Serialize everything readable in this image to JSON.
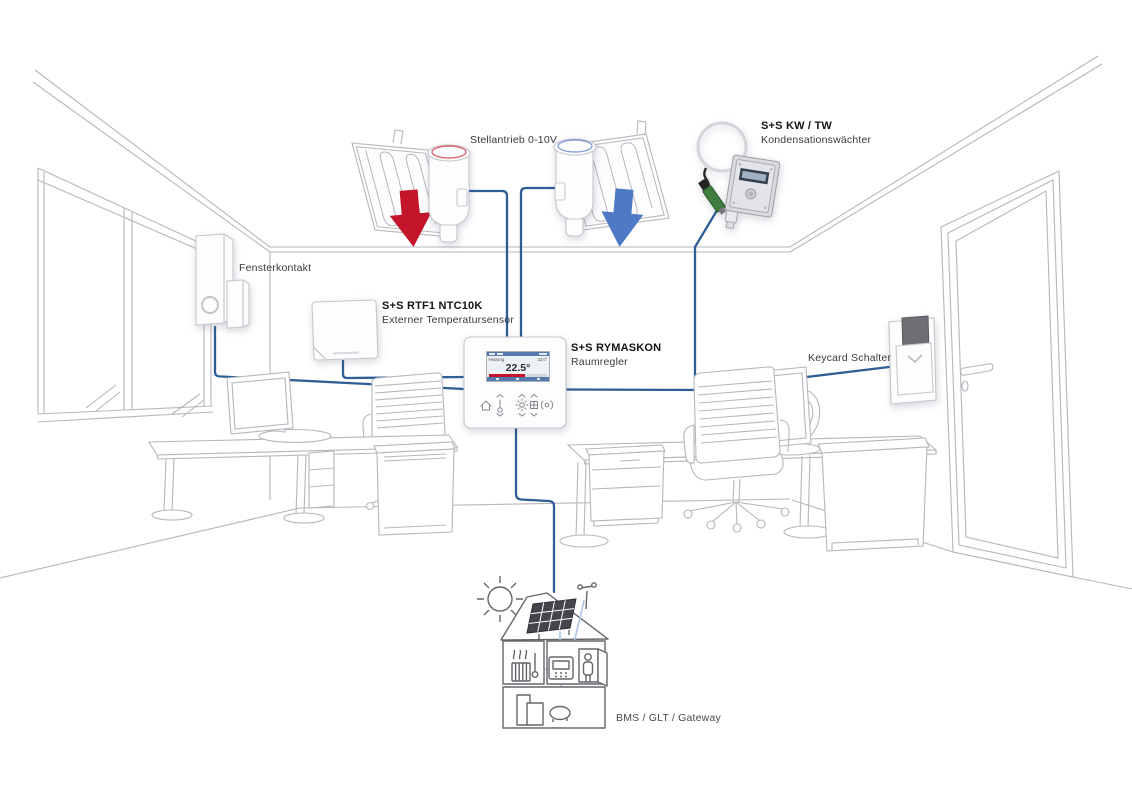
{
  "diagram": {
    "labels": {
      "actuator": {
        "text": "Stellantrieb 0-10V"
      },
      "condensation": {
        "title": "S+S KW / TW",
        "subtitle": "Kondensationswächter"
      },
      "window_contact": {
        "text": "Fensterkontakt"
      },
      "ext_temp_sensor": {
        "title": "S+S RTF1 NTC10K",
        "subtitle": "Externer Temperatursensor"
      },
      "room_controller": {
        "title": "S+S RYMASKON",
        "subtitle": "Raumregler"
      },
      "keycard": {
        "text": "Keycard Schalter"
      },
      "bms": {
        "text": "BMS / GLT / Gateway"
      }
    },
    "controller": {
      "brand": "S+S REGELTECHNIK",
      "display": {
        "mode": "Heizung",
        "setpoint": "22.0°",
        "temperature": "22.5°"
      },
      "buttons": [
        {
          "icon": "house-icon"
        },
        {
          "icon": "thermometer-icon"
        },
        {
          "icon": "sun-icon"
        },
        {
          "icon": "grid-icon"
        },
        {
          "icon": "presence-icon"
        }
      ]
    },
    "colors": {
      "wire": "#2e5e95",
      "wire_light": "#a9c6e4",
      "arrow_heating": "#c4142a",
      "arrow_cooling": "#4e79c4",
      "outline": "#b6b6bd",
      "house_outline": "#65656b",
      "display_accent": "#5679ad",
      "background": "#ffffff"
    }
  }
}
